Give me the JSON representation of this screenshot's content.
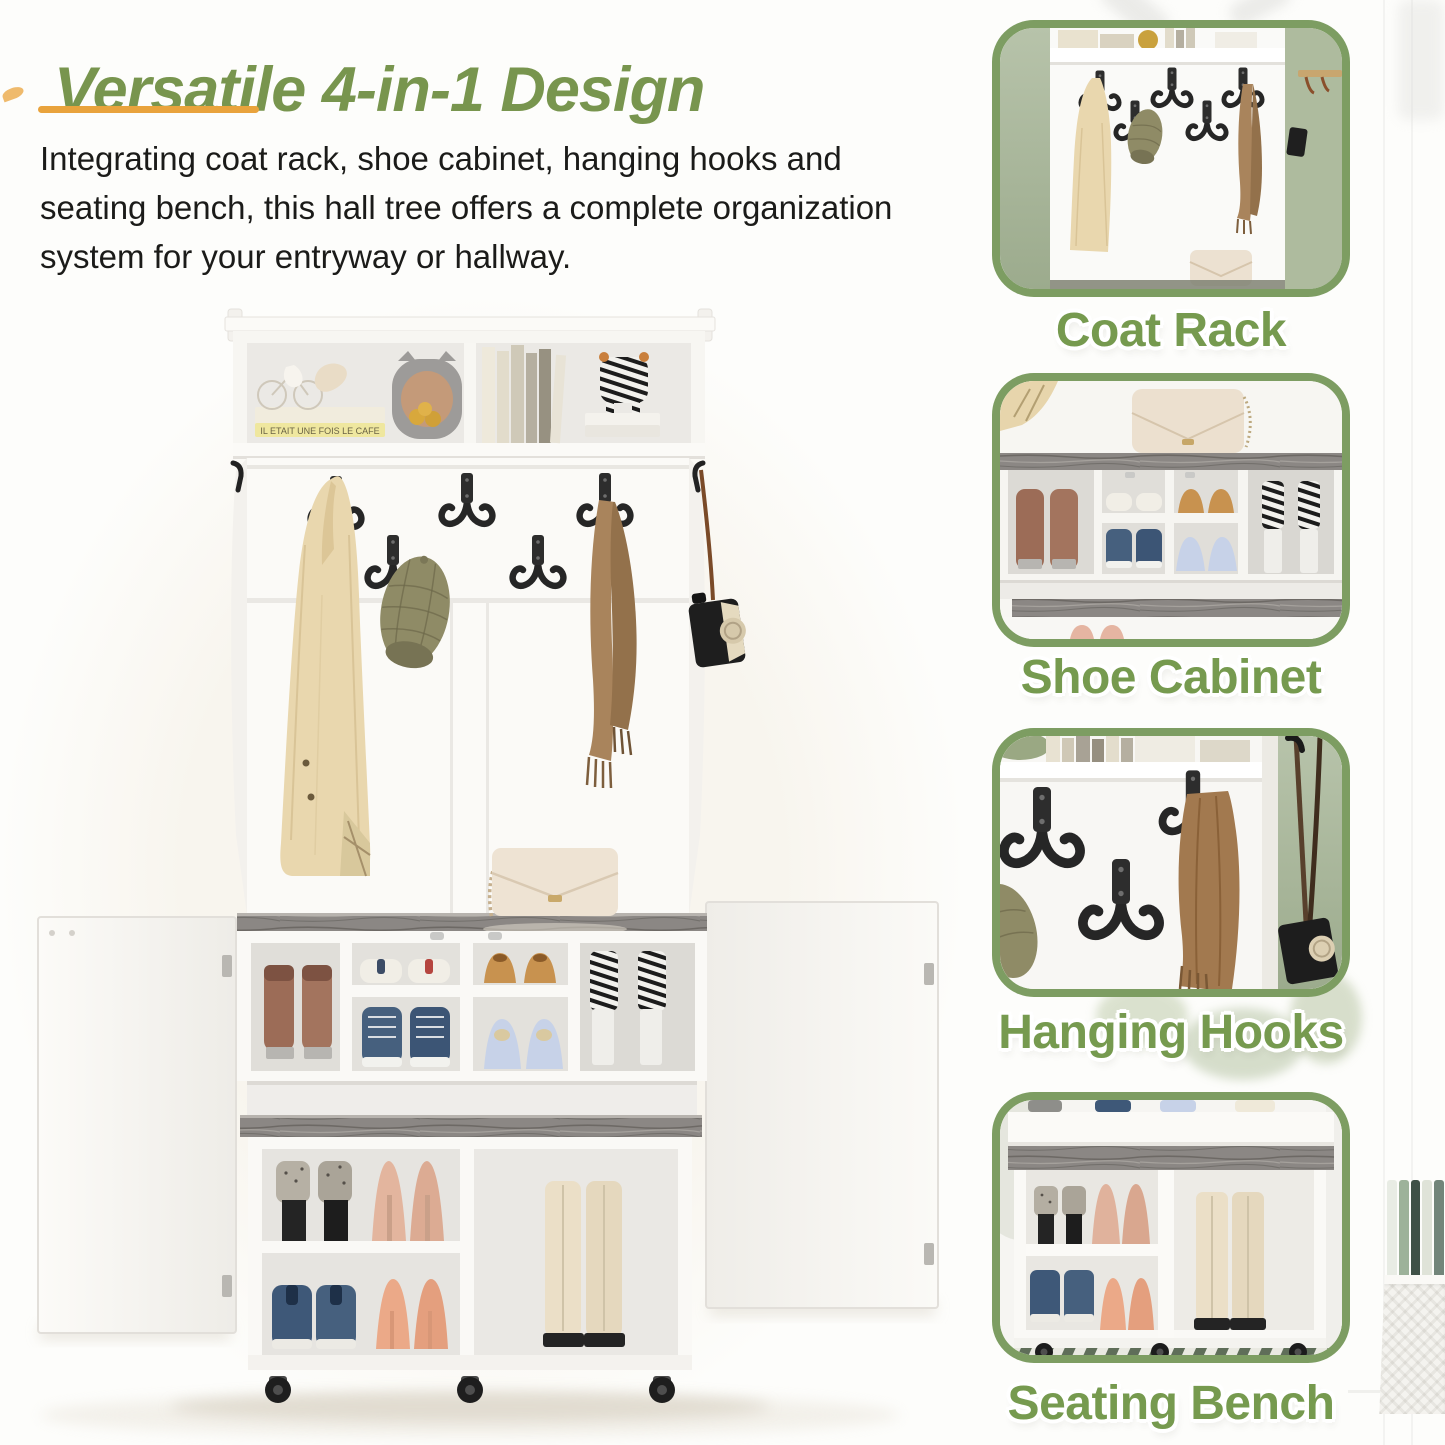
{
  "header": {
    "title": "Versatile 4-in-1 Design",
    "description_lines": [
      "Integrating coat rack, shoe cabinet, hanging hooks and",
      "seating bench, this hall tree offers a complete organization",
      "system for your entryway or hallway."
    ]
  },
  "features": [
    {
      "label": "Coat Rack"
    },
    {
      "label": "Shoe Cabinet"
    },
    {
      "label": "Hanging Hooks"
    },
    {
      "label": "Seating Bench"
    }
  ],
  "decor": {
    "book_spine_text": "IL ETAIT UNE FOIS LE CAFE"
  },
  "colors": {
    "title_green": "#78954e",
    "caption_green": "#769a4f",
    "underline_orange": "#e9a33c",
    "frame_border_green": "#7d9d62",
    "wood_gray": "#8b8784",
    "sage_wall": "#b3c0a6"
  }
}
